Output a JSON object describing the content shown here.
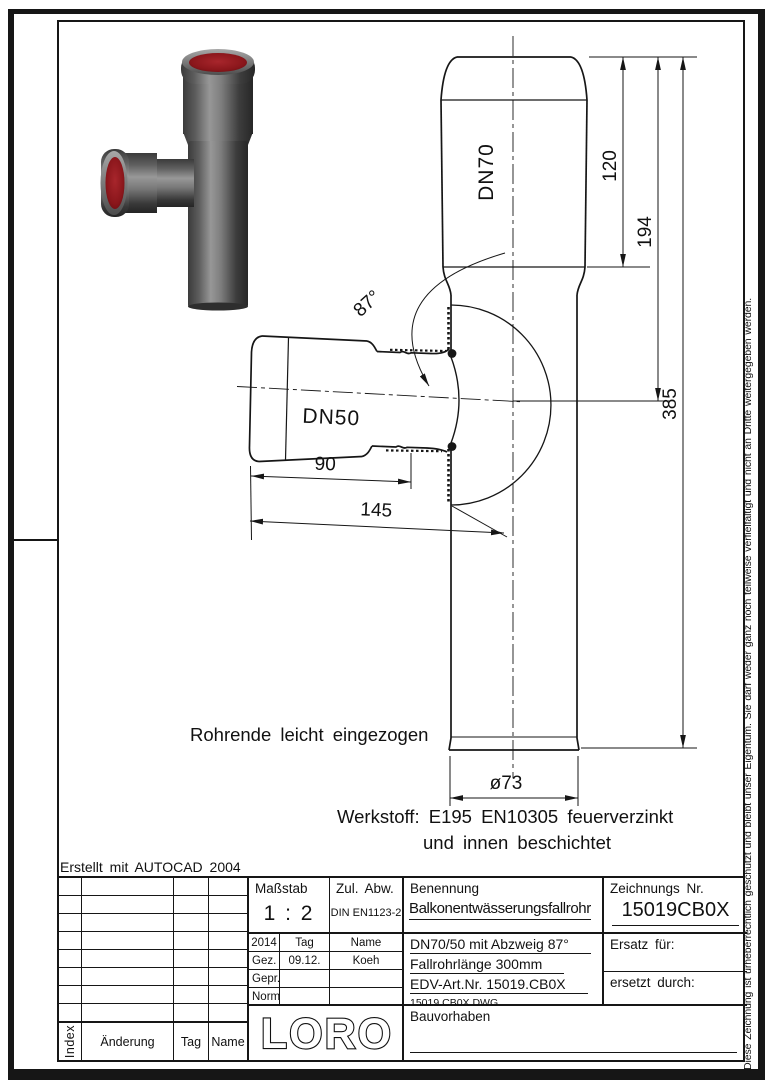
{
  "page": {
    "created_with": "Erstellt mit AUTOCAD 2004",
    "copyright_note": "Diese Zeichnung ist urheberrechtlich geschützt und bleibt unser Eigentum. Sie darf weder ganz noch teilweise verfielfältigt und nicht an Dritte weitergegeben werden."
  },
  "drawing": {
    "pipe_label_main": "DN70",
    "pipe_label_branch": "DN50",
    "angle_label": "87°",
    "dim_socket_length": "120",
    "dim_to_branch_axis": "194",
    "dim_total_length": "385",
    "dim_branch_socket": "90",
    "dim_branch_total": "145",
    "dim_diameter": "ø73",
    "note_pipe_end": "Rohrende leicht eingezogen",
    "note_material_1": "Werkstoff: E195 EN10305 feuerverzinkt",
    "note_material_2": "und innen beschichtet"
  },
  "title_block": {
    "massstab": {
      "label": "Maßstab",
      "value": "1 : 2"
    },
    "zul_abw": {
      "label": "Zul. Abw.",
      "value": "DIN EN1123-2"
    },
    "benennung": {
      "label": "Benennung",
      "value": "Balkonentwässerungsfallrohr"
    },
    "zeichnungs_nr": {
      "label": "Zeichnungs Nr.",
      "value": "15019CB0X"
    },
    "approval": {
      "year": "2014",
      "col_tag": "Tag",
      "col_name": "Name",
      "rows": [
        {
          "label": "Gez.",
          "tag": "09.12.",
          "name": "Koeh"
        },
        {
          "label": "Gepr.",
          "tag": "",
          "name": ""
        },
        {
          "label": "Norm.",
          "tag": "",
          "name": ""
        }
      ]
    },
    "description": {
      "line1": "DN70/50 mit Abzweig 87°",
      "line2": "Fallrohrlänge 300mm",
      "line3": "EDV-Art.Nr. 15019.CB0X",
      "line4": "15019.CB0X.DWG"
    },
    "ersatz_fuer": "Ersatz für:",
    "ersetzt_durch": "ersetzt durch:",
    "logo_text": "LORO",
    "bauvorhaben": "Bauvorhaben",
    "revision_header": {
      "index": "Index",
      "aenderung": "Änderung",
      "tag": "Tag",
      "name": "Name"
    }
  },
  "colors": {
    "line": "#161616",
    "pipe_gray": "#6e6e6e",
    "opening_red": "#8c1418"
  }
}
